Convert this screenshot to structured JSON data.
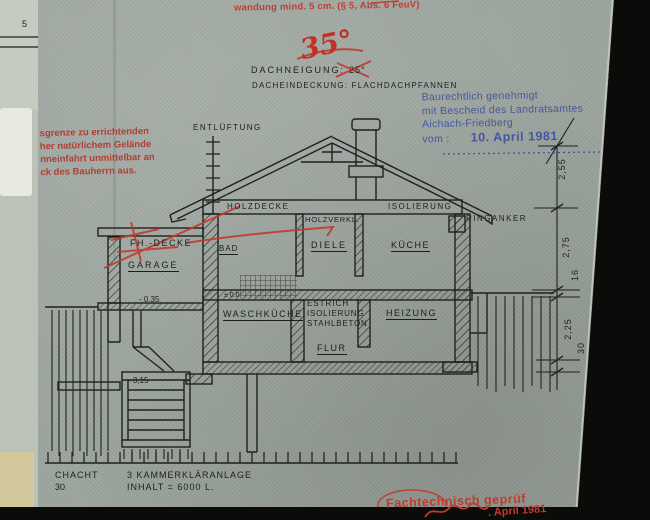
{
  "page": {
    "margin_number": "5"
  },
  "notes": {
    "top_red_note": "wandung mind. 5 cm. (§ 5, Abs. 6 FeuV)",
    "pitch_new": "35°",
    "pitch_label": "DACHNEIGUNG:",
    "pitch_old": "25°",
    "covering_label": "DACHEINDECKUNG:  FLACHDACHPFANNEN"
  },
  "stamps": {
    "approval": {
      "line1": "Baurechtlich genehmigt",
      "line2": "mit Bescheid des Landratsamtes",
      "line3": "Aichach-Friedberg",
      "line4_prefix": "vom :",
      "date": "10. April 1981",
      "color": "#3f51a0"
    },
    "boundary_note": {
      "line1": "sgrenze zu errichtenden",
      "line2": "her natürlichem Gelände",
      "line3": "nneinfahrt unmittelbar an",
      "line4": "ck des Bauherrn aus.",
      "color": "#b0372b"
    },
    "review": {
      "text": "Fachtechnisch geprüf",
      "date_fragment": ". April 1981",
      "color": "#c23a2c"
    }
  },
  "labels": {
    "entlueftung": "ENTLÜFTUNG",
    "holzdecke": "HOLZDECKE",
    "isolierung_roof": "ISOLIERUNG",
    "holzverkl": "HOLZVERKL.",
    "ringanker": "RINGANKER",
    "fh_decke": "FH.-DECKE",
    "garage": "GARAGE",
    "bad": "BAD",
    "diele": "DIELE",
    "kueche": "KÜCHE",
    "waschkueche": "WASCHKÜCHE",
    "estrich": "ESTRICH",
    "isolierung_floor": "ISOLIERUNG",
    "stahlbeton": "STAHLBETON",
    "flur": "FLUR",
    "heizung": "HEIZUNG"
  },
  "levels": {
    "garage_floor": "- 0.35",
    "ground_floor": "± 0.0",
    "tank_bottom": "- 3,15"
  },
  "dimensions": {
    "roof": "2,55",
    "ground_floor_height": "2,75",
    "ceiling": "16",
    "basement_height": "2,25",
    "slab": "30"
  },
  "footer": {
    "shaft_label": "CHACHT",
    "shaft_value": "30",
    "tank_label": "3 KAMMERKLÄRANLAGE",
    "tank_capacity": "INHALT = 6000 L."
  }
}
